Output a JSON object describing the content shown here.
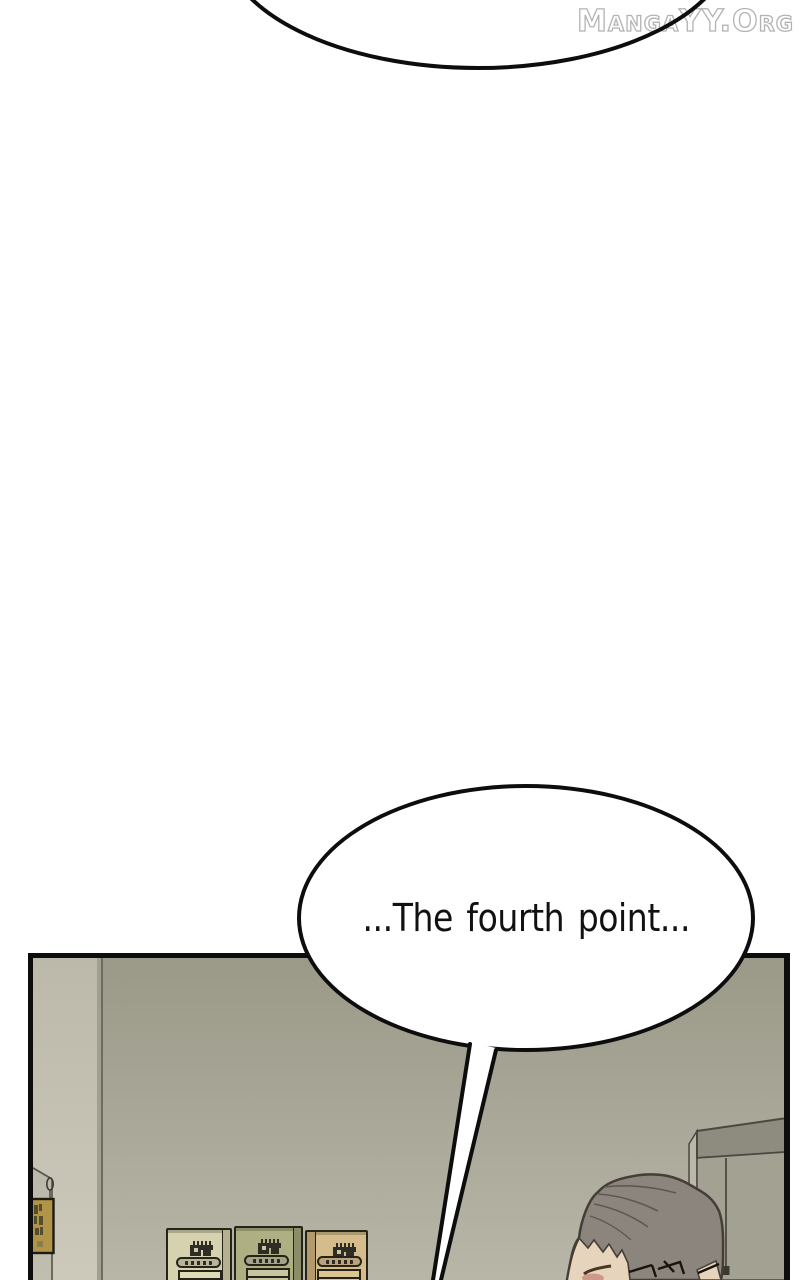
{
  "watermark": {
    "text": "MangaYY.Org"
  },
  "bubbles": {
    "main": {
      "text": "...The fourth point..."
    }
  },
  "colors": {
    "outline": "#0d0d0d",
    "wall_top": "#9a9887",
    "wall_bottom": "#b8b6a7",
    "door_top": "#bcb9ab",
    "door_bottom": "#ccc9bb",
    "sign_fill": "#b09549",
    "m1_body": "#d6d2af",
    "m1_side": "#b5b190",
    "m1_bar": "#b7b499",
    "m1_panel": "#dfdbb8",
    "m2_body": "#aeb083",
    "m2_side": "#8b8d68",
    "m2_bar": "#a5a389",
    "m2_panel": "#c6c4a1",
    "m3_body": "#d5bc8d",
    "m3_side": "#b29a6d",
    "m3_bar": "#b8a37c",
    "m3_panel": "#ddc593",
    "cabinet_top": "#8e8c7e",
    "cabinet_front": "#a3a192",
    "cabinet_sliver": "#bab8a9",
    "hair": "#8c857e",
    "skin": "#e6d5bc"
  }
}
